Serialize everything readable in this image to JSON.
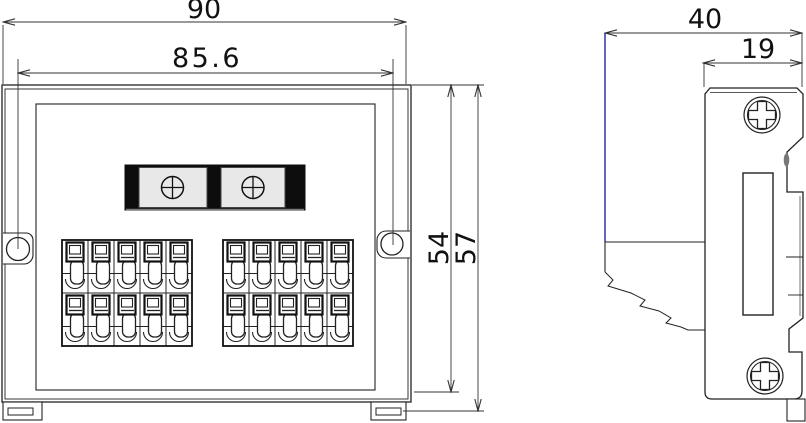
{
  "drawing": {
    "type": "technical-dimension-drawing",
    "front_view": {
      "dim_width_outer": "90",
      "dim_hole_spacing": "85.6",
      "dim_height_body": "54",
      "dim_height_total": "57",
      "terminal_blocks": {
        "count": 2,
        "columns": 5,
        "rows": 2
      },
      "label_strip": {
        "screw_count": 2,
        "bar_color": "#0d0d0d",
        "panel_color": "#e8e8e8"
      },
      "mounting_holes": 2
    },
    "side_view": {
      "dim_depth_total": "40",
      "dim_depth_body": "19",
      "screw_count": 2
    },
    "colors": {
      "line": "#222222",
      "dimension_line": "#333333",
      "extension_blue": "#00008c",
      "background": "#ffffff"
    }
  }
}
